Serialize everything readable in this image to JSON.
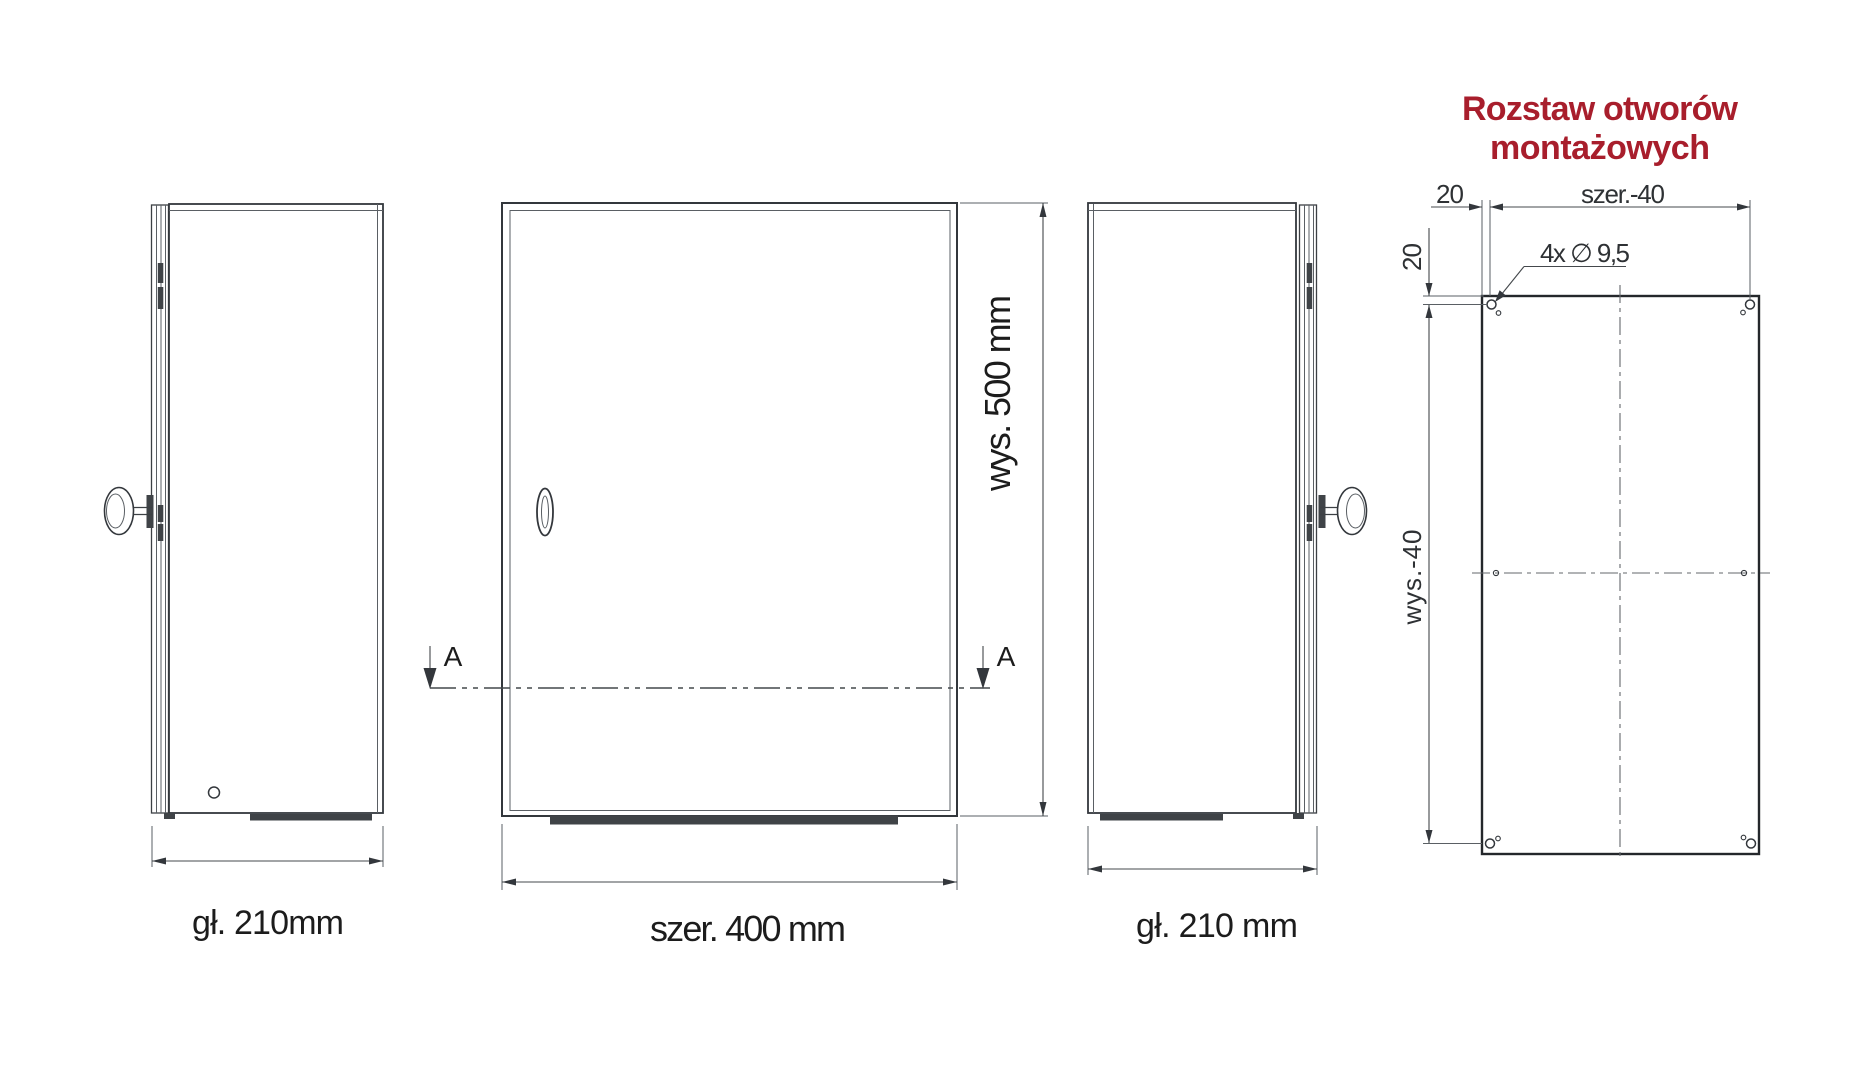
{
  "drawing": {
    "accent_color": "#a81e2c",
    "title": {
      "line1": "Rozstaw otworów",
      "line2": "montażowych"
    },
    "labels": {
      "left_depth": "gł. 210mm",
      "front_width": "szer. 400 mm",
      "front_height": "wys. 500 mm",
      "right_depth": "gł. 210 mm",
      "section_left": "A",
      "section_right": "A"
    },
    "mounting": {
      "offset_top": "20",
      "offset_side": "20",
      "width": "szer.-40",
      "height": "wys.-40",
      "holes": "4x ∅ 9,5"
    }
  }
}
